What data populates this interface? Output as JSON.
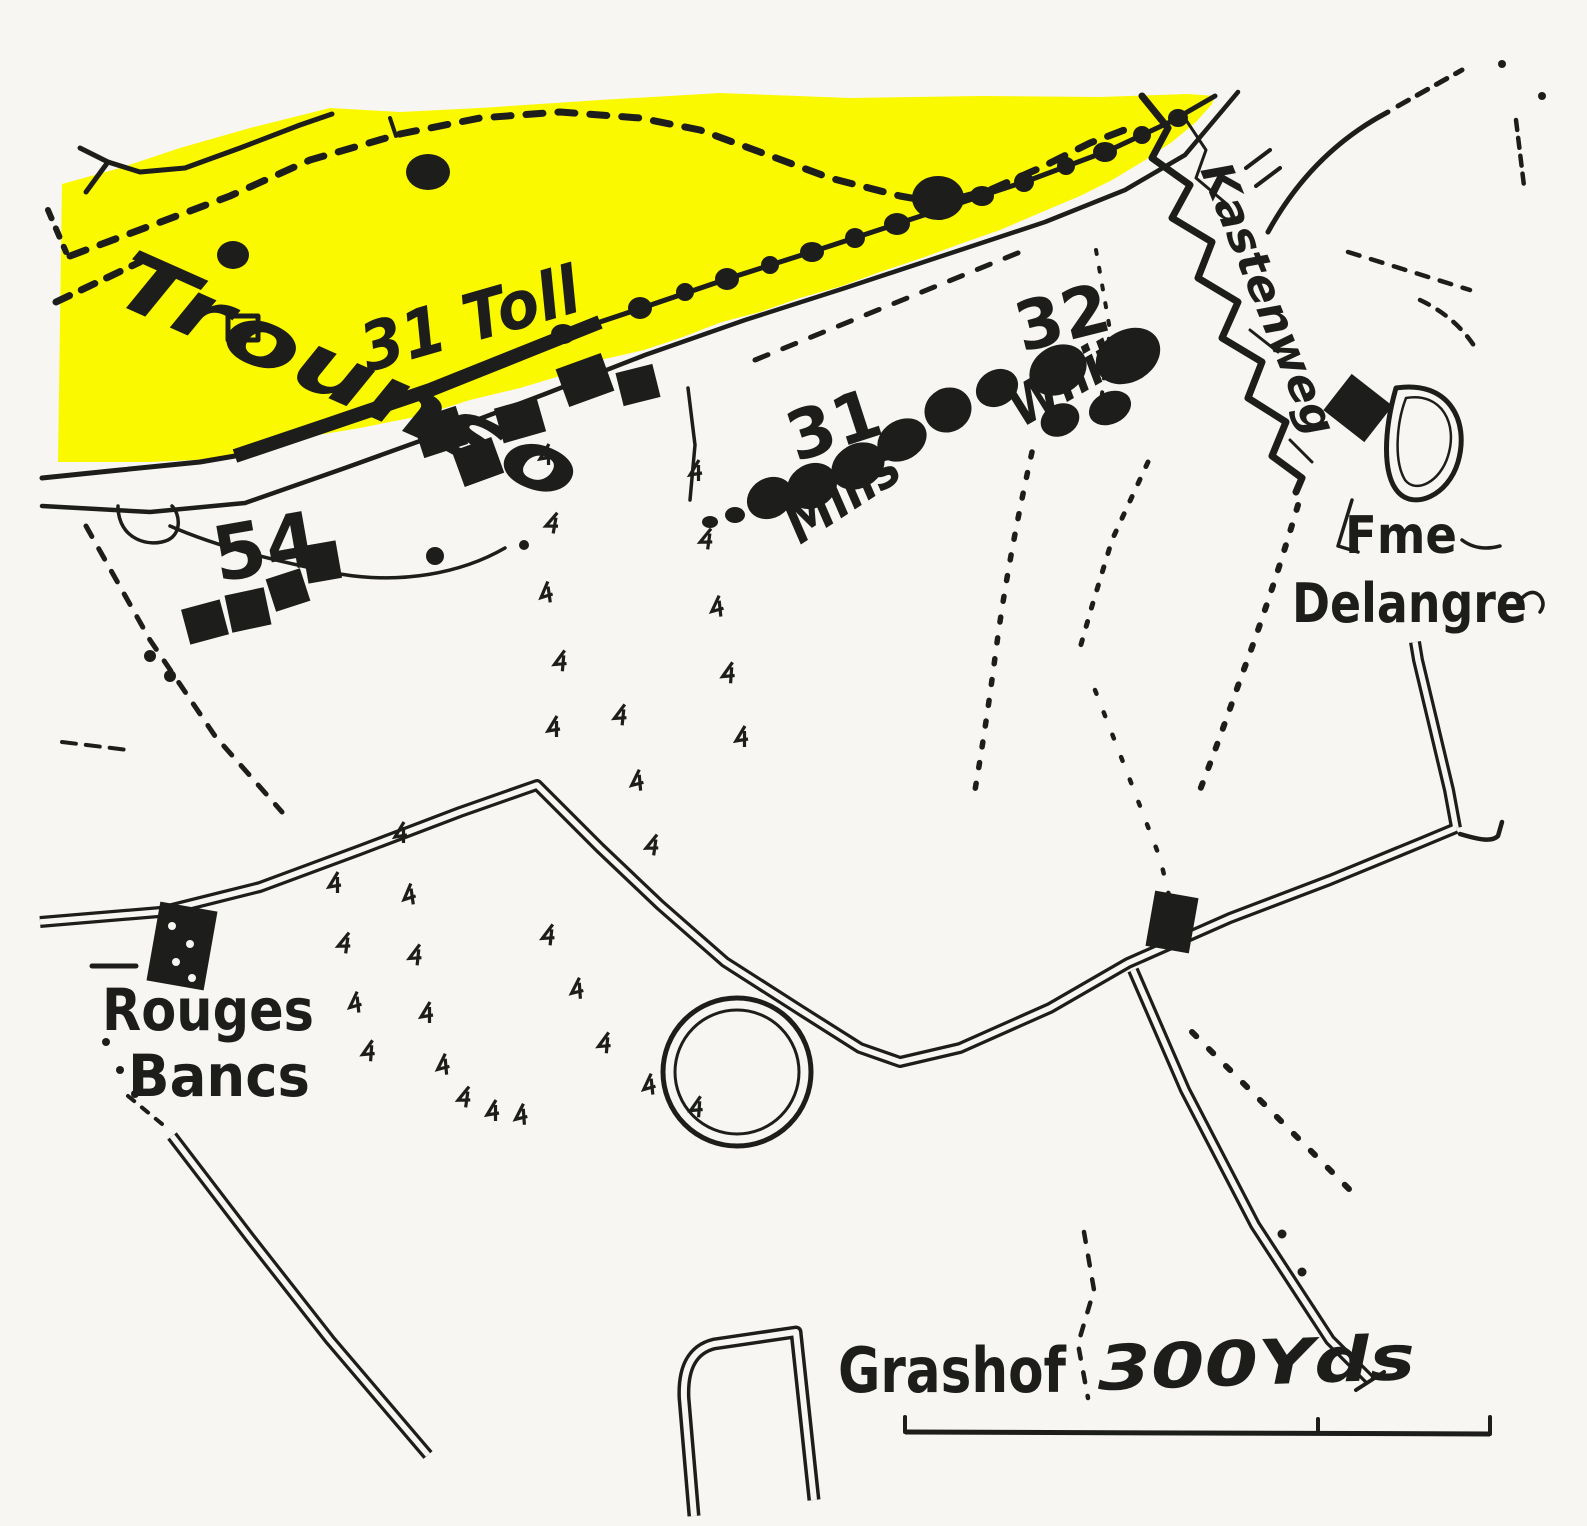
{
  "colors": {
    "highlight": "#fbf900",
    "ink": "#1d1d1b",
    "paper": "#f7f6f2"
  },
  "map": {
    "labels": {
      "place_trounso": "Trounso",
      "unit_31_toll": "31 Toll",
      "unit_31": "31",
      "name_mills": "Mills",
      "unit_32": "32",
      "name_white": "White",
      "unit_54": "54",
      "trench_kastenweg": "Kastenweg",
      "farm_fme": "Fme",
      "farm_delangre": "Delangre",
      "place_rouges": "Rouges",
      "place_bancs": "Bancs",
      "place_grashof": "Grashof",
      "scale_label": "300Yds"
    }
  }
}
